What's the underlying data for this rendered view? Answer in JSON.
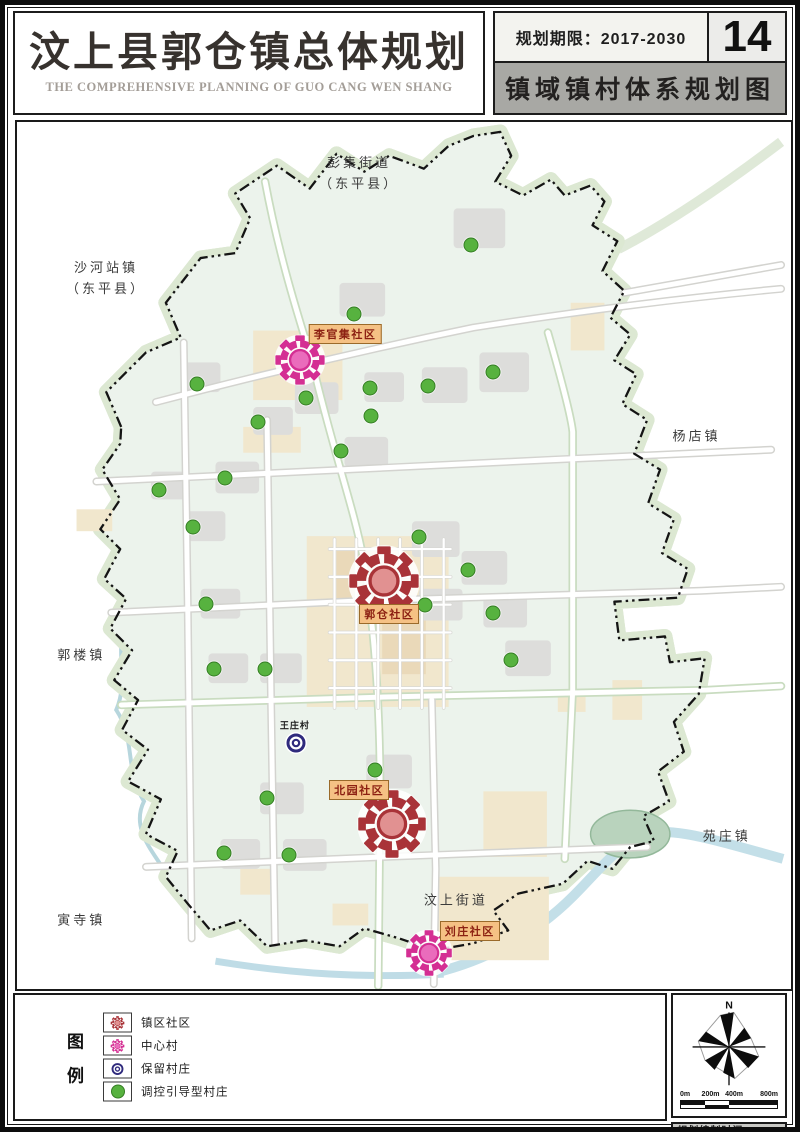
{
  "header": {
    "title": "汶上县郭仓镇总体规划",
    "subtitle": "THE COMPREHENSIVE PLANNING OF GUO CANG WEN SHANG",
    "period_label": "规划期限：2017-2030",
    "page_number": "14",
    "map_title": "镇域镇村体系规划图"
  },
  "map": {
    "neighbors": [
      {
        "name": "pengji-street",
        "lines": [
          "彭集街道",
          "（东平县）"
        ],
        "x": 44.2,
        "y": 6.0
      },
      {
        "name": "shahezhan-town",
        "lines": [
          "沙河站镇",
          "（东平县）"
        ],
        "x": 11.5,
        "y": 18.1
      },
      {
        "name": "yangdian-town",
        "lines": [
          "杨店镇"
        ],
        "x": 87.8,
        "y": 36.3
      },
      {
        "name": "guolou-town",
        "lines": [
          "郭楼镇"
        ],
        "x": 8.3,
        "y": 61.6
      },
      {
        "name": "yuanzhuang-town",
        "lines": [
          "苑庄镇"
        ],
        "x": 91.7,
        "y": 82.5
      },
      {
        "name": "yinsi-town",
        "lines": [
          "寅寺镇"
        ],
        "x": 8.3,
        "y": 92.2
      },
      {
        "name": "wenshang-street",
        "lines": [
          "汶上街道"
        ],
        "x": 56.7,
        "y": 89.9
      }
    ],
    "markers": [
      {
        "name": "liguanji-community",
        "type": "center",
        "label": "李官集社区",
        "x": 36.5,
        "y": 27.5,
        "size": 54,
        "label_x": 42.4,
        "label_y": 24.5
      },
      {
        "name": "guocang-community",
        "type": "community",
        "label": "郭仓社区",
        "x": 47.4,
        "y": 52.9,
        "size": 76,
        "label_x": 48.1,
        "label_y": 56.8
      },
      {
        "name": "beiyuan-community",
        "type": "community",
        "label": "北园社区",
        "x": 48.5,
        "y": 81.0,
        "size": 74,
        "label_x": 44.2,
        "label_y": 77.0
      },
      {
        "name": "liuzhuang-community",
        "type": "center",
        "label": "刘庄社区",
        "x": 53.2,
        "y": 95.9,
        "size": 50,
        "label_x": 58.5,
        "label_y": 93.3
      },
      {
        "name": "wangzhuang-village",
        "type": "retained",
        "label": "王庄村",
        "x": 36.0,
        "y": 71.6,
        "size": 24,
        "label_x": 35.9,
        "label_y": 69.5
      }
    ],
    "green_dots": [
      [
        58.7,
        14.2
      ],
      [
        43.6,
        22.1
      ],
      [
        23.2,
        30.2
      ],
      [
        37.4,
        31.8
      ],
      [
        45.6,
        30.7
      ],
      [
        53.1,
        30.4
      ],
      [
        61.5,
        28.8
      ],
      [
        31.2,
        34.6
      ],
      [
        45.8,
        33.9
      ],
      [
        41.9,
        37.9
      ],
      [
        26.9,
        41.1
      ],
      [
        18.3,
        42.4
      ],
      [
        22.8,
        46.7
      ],
      [
        51.9,
        47.9
      ],
      [
        58.3,
        51.7
      ],
      [
        52.7,
        55.7
      ],
      [
        61.5,
        56.6
      ],
      [
        24.4,
        55.6
      ],
      [
        63.8,
        62.0
      ],
      [
        25.4,
        63.1
      ],
      [
        32.1,
        63.1
      ],
      [
        46.2,
        74.7
      ],
      [
        32.3,
        78.0
      ],
      [
        26.8,
        84.3
      ],
      [
        35.1,
        84.6
      ]
    ]
  },
  "legend": {
    "title_chars": [
      "图",
      "例"
    ],
    "items": [
      {
        "name": "legend-town-community",
        "type": "community",
        "label": "镇区社区"
      },
      {
        "name": "legend-center-village",
        "type": "center",
        "label": "中心村"
      },
      {
        "name": "legend-retained-village",
        "type": "retained",
        "label": "保留村庄"
      },
      {
        "name": "legend-guided-village",
        "type": "guided",
        "label": "调控引导型村庄"
      }
    ]
  },
  "compass": {
    "north_label": "N"
  },
  "scalebar": {
    "labels": [
      "0m",
      "200m",
      "400m",
      "800m"
    ]
  },
  "credits": {
    "line1": "规划编制时间：2017",
    "line2": "汶上县郭仓镇人民政府"
  },
  "colors": {
    "community_main": "#a93338",
    "community_inner": "#e19191",
    "center_main": "#d42f93",
    "center_inner": "#ea6cbc",
    "retained": "#2f2a7d",
    "guided": "#57b23f",
    "chip_bg": "#f5c184",
    "chip_text": "#8c2012",
    "boundary": "#141414",
    "town_fill": "#ecf3ec"
  }
}
